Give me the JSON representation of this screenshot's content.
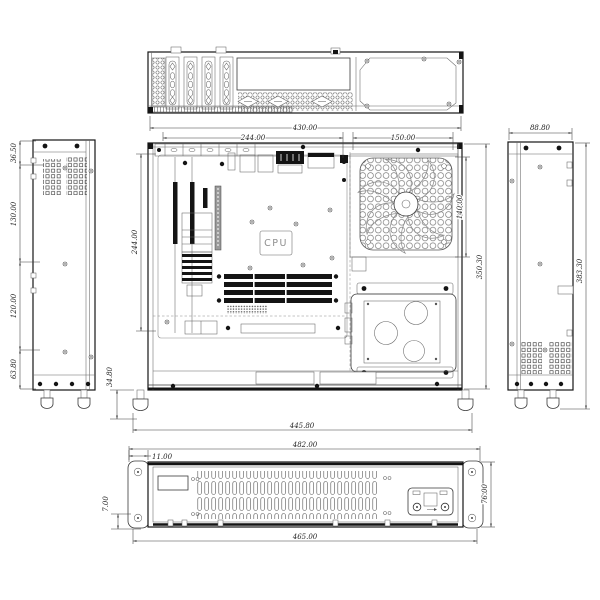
{
  "drawing": {
    "type": "engineering-orthographic-drawing",
    "subject": "2U rackmount computer chassis",
    "cpu_label": "CPU",
    "dims": {
      "main_width_total": "430.00",
      "main_width_left": "244.00",
      "main_width_right": "150.00",
      "main_board_height": "244.00",
      "main_fan_height": "140.00",
      "main_height_total": "350.30",
      "main_foot_height": "34.80",
      "left_seg1": "36.50",
      "left_seg2": "130.00",
      "left_seg3": "120.00",
      "left_seg4": "63.80",
      "right_width": "88.80",
      "right_height": "383.30",
      "front_feet_span": "445.80",
      "front_width_top": "482.00",
      "front_ear_offset": "11.00",
      "front_flange_height": "7.00",
      "front_panel_height": "76.00",
      "front_width_bottom": "465.00"
    }
  }
}
